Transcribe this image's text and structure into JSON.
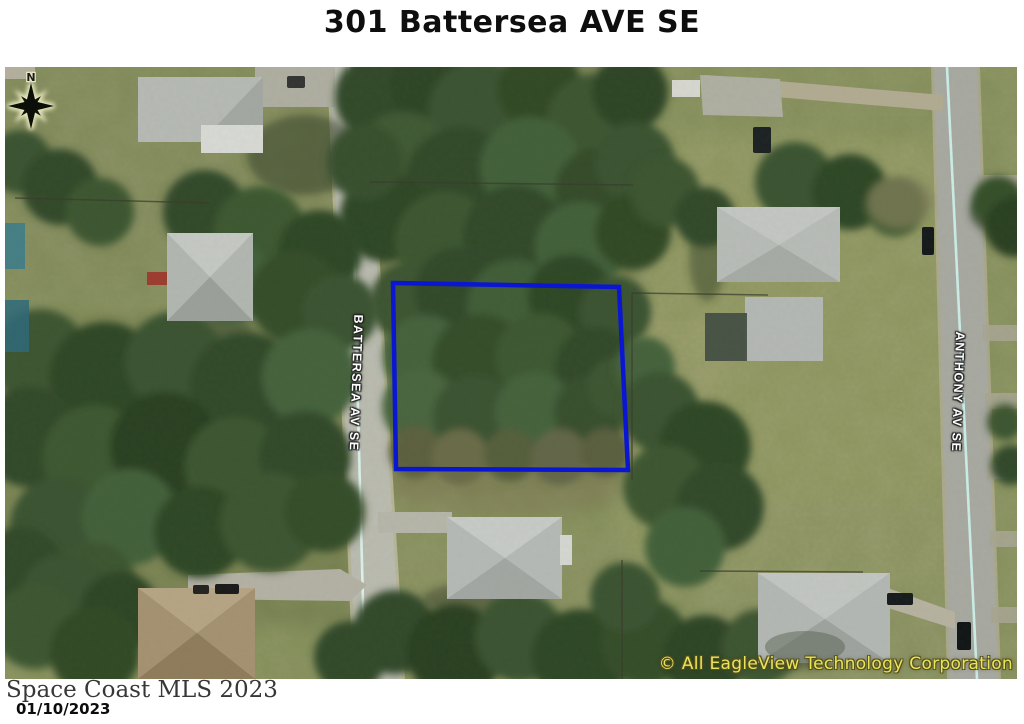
{
  "title": "301 Battersea AVE SE",
  "map": {
    "street_label_left": "BATTERSEA AV SE",
    "street_label_right": "ANTHONY AV SE",
    "compass_label": "N",
    "copyright": "© All EagleView Technology Corporation",
    "lot_outline_color": "#0a16d2",
    "label_color": "#ffffff",
    "copyright_color": "#e9e45a"
  },
  "footer": {
    "mls_text": "Space Coast MLS 2023",
    "date": "01/10/2023"
  }
}
